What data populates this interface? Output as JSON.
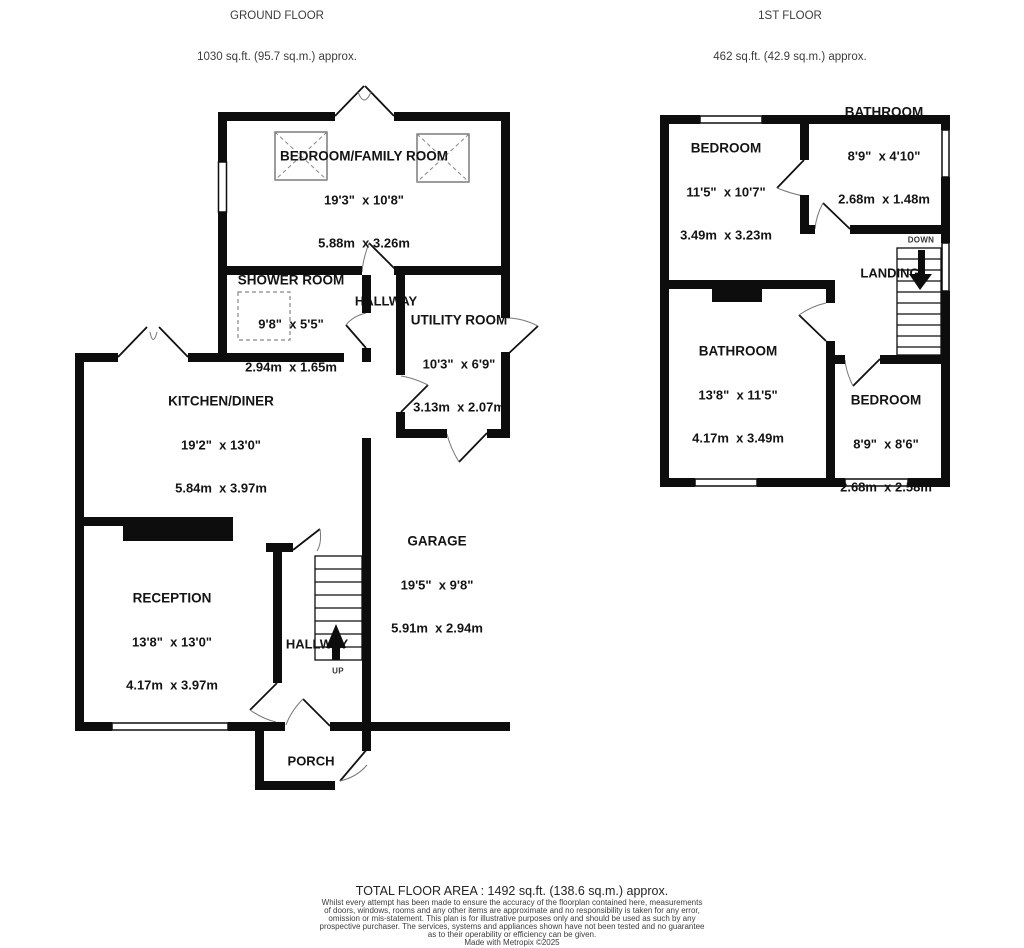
{
  "ground_floor": {
    "title": "GROUND FLOOR",
    "area": "1030 sq.ft. (95.7 sq.m.) approx.",
    "rooms": {
      "bedroom_family": {
        "name": "BEDROOM/FAMILY ROOM",
        "imperial": "19'3\"  x 10'8\"",
        "metric": "5.88m  x 3.26m"
      },
      "shower": {
        "name": "SHOWER ROOM",
        "imperial": "9'8\"  x 5'5\"",
        "metric": "2.94m  x 1.65m"
      },
      "utility": {
        "name": "UTILITY ROOM",
        "imperial": "10'3\"  x 6'9\"",
        "metric": "3.13m  x 2.07m"
      },
      "kitchen": {
        "name": "KITCHEN/DINER",
        "imperial": "19'2\"  x 13'0\"",
        "metric": "5.84m  x 3.97m"
      },
      "garage": {
        "name": "GARAGE",
        "imperial": "19'5\"  x 9'8\"",
        "metric": "5.91m  x 2.94m"
      },
      "reception": {
        "name": "RECEPTION",
        "imperial": "13'8\"  x 13'0\"",
        "metric": "4.17m  x 3.97m"
      }
    },
    "labels": {
      "hallway_upper": "HALLWAY",
      "hallway_lower": "HALLWAY",
      "up": "UP",
      "porch": "PORCH"
    }
  },
  "first_floor": {
    "title": "1ST FLOOR",
    "area": "462 sq.ft. (42.9 sq.m.) approx.",
    "rooms": {
      "bedroom1": {
        "name": "BEDROOM",
        "imperial": "11'5\"  x 10'7\"",
        "metric": "3.49m  x 3.23m"
      },
      "bathroom1": {
        "name": "BATHROOM",
        "imperial": "8'9\"  x 4'10\"",
        "metric": "2.68m  x 1.48m"
      },
      "bathroom2": {
        "name": "BATHROOM",
        "imperial": "13'8\"  x 11'5\"",
        "metric": "4.17m  x 3.49m"
      },
      "bedroom2": {
        "name": "BEDROOM",
        "imperial": "8'9\"  x 8'6\"",
        "metric": "2.68m  x 2.58m"
      }
    },
    "labels": {
      "landing": "LANDING",
      "down": "DOWN"
    }
  },
  "footer": {
    "total": "TOTAL FLOOR AREA : 1492 sq.ft. (138.6 sq.m.) approx.",
    "disclaimer": [
      "Whilst every attempt has been made to ensure the accuracy of the floorplan contained here, measurements",
      "of doors, windows, rooms and any other items are approximate and no responsibility is taken for any error,",
      "omission or mis-statement. This plan is for illustrative purposes only and should be used as such by any",
      "prospective purchaser. The services, systems and appliances shown have not been tested and no guarantee",
      "as to their operability or efficiency can be given."
    ],
    "credit": "Made with Metropix ©2025"
  },
  "colors": {
    "wall": "#0d0d0d",
    "text": "#141414"
  }
}
